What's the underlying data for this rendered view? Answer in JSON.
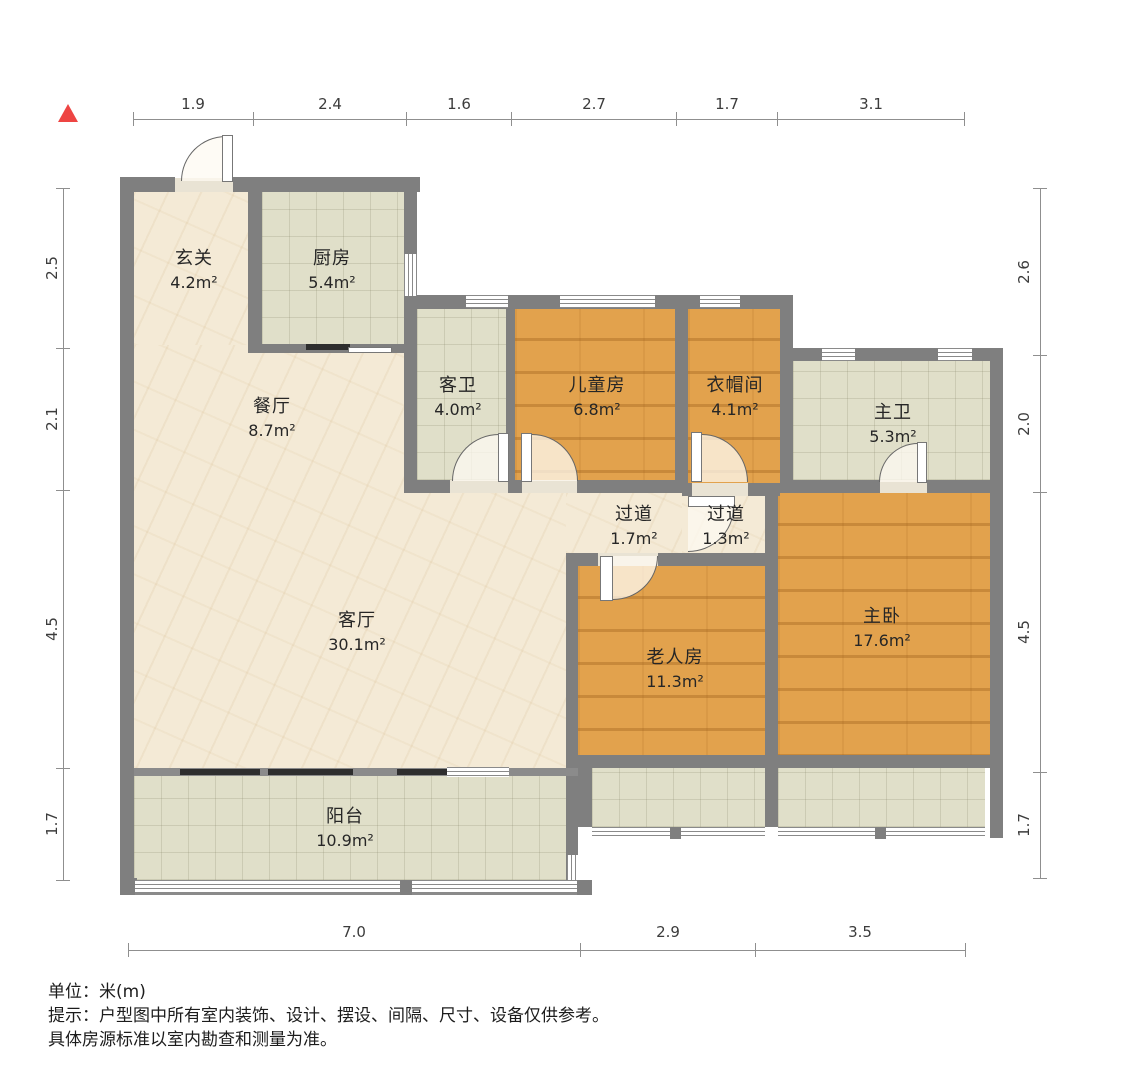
{
  "north_indicator": "north-arrow",
  "dimensions": {
    "top": [
      "1.9",
      "2.4",
      "1.6",
      "2.7",
      "1.7",
      "3.1"
    ],
    "left": [
      "2.5",
      "2.1",
      "4.5",
      "1.7"
    ],
    "right": [
      "2.6",
      "2.0",
      "4.5",
      "1.7"
    ],
    "bottom": [
      "7.0",
      "2.9",
      "3.5"
    ]
  },
  "rooms": {
    "xuanguan": {
      "name": "玄关",
      "area": "4.2m²"
    },
    "chufang": {
      "name": "厨房",
      "area": "5.4m²"
    },
    "canting": {
      "name": "餐厅",
      "area": "8.7m²"
    },
    "kewei": {
      "name": "客卫",
      "area": "4.0m²"
    },
    "ertongfang": {
      "name": "儿童房",
      "area": "6.8m²"
    },
    "yimaojian": {
      "name": "衣帽间",
      "area": "4.1m²"
    },
    "zhuwei": {
      "name": "主卫",
      "area": "5.3m²"
    },
    "guodao_a": {
      "name": "过道",
      "area": "1.7m²"
    },
    "guodao_b": {
      "name": "过道",
      "area": "1.3m²"
    },
    "keting": {
      "name": "客厅",
      "area": "30.1m²"
    },
    "laorenfang": {
      "name": "老人房",
      "area": "11.3m²"
    },
    "zhuwo": {
      "name": "主卧",
      "area": "17.6m²"
    },
    "yangtai": {
      "name": "阳台",
      "area": "10.9m²"
    }
  },
  "footer": {
    "unit": "单位：米(m)",
    "tip1": "提示：户型图中所有室内装饰、设计、摆设、间隔、尺寸、设备仅供参考。",
    "tip2": "具体房源标准以室内勘查和测量为准。"
  },
  "colors": {
    "wall": "#7f7f7f",
    "wood_floor": "#e2a24d",
    "tile_floor": "#e0dfc9",
    "living_floor": "#f4ead6",
    "north_arrow": "#ee4543"
  }
}
